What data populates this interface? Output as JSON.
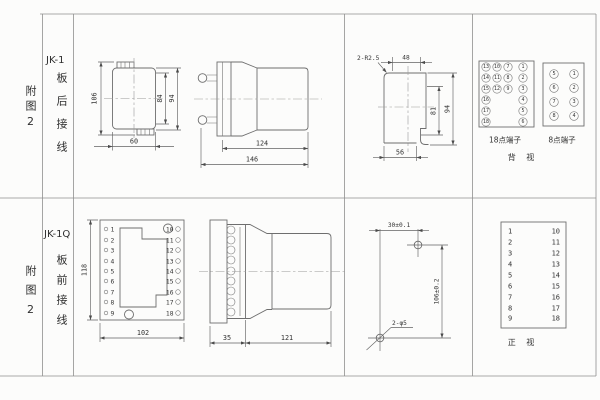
{
  "sidebar": {
    "row1": {
      "figure": "附图2",
      "model": "JK-1",
      "wiring": "板后接线"
    },
    "row2": {
      "figure": "附图2",
      "model": "JK-1Q",
      "wiring": "板前接线"
    }
  },
  "rear_view": {
    "dim_height": "106",
    "dim_inner": "84",
    "dim_outer": "94",
    "dim_width": "60"
  },
  "side_view_top": {
    "dim_body": "124",
    "dim_overall": "146"
  },
  "cutout": {
    "radius_note": "2-R2.5",
    "dim_top": "48",
    "dim_inner_h": "81",
    "dim_outer_h": "94",
    "dim_bottom": "56"
  },
  "terminals18": {
    "label": "18点端子",
    "col_outer_left": [
      "13",
      "14",
      "15",
      "16",
      "17",
      "18"
    ],
    "col_inner_left": [
      "10",
      "11",
      "12"
    ],
    "col_inner_right": [
      "7",
      "8",
      "9"
    ],
    "col_outer_right": [
      "1",
      "2",
      "3",
      "4",
      "5",
      "6"
    ]
  },
  "terminals8": {
    "label": "8点端子",
    "col_left": [
      "5",
      "6",
      "7",
      "8"
    ],
    "col_right": [
      "1",
      "2",
      "3",
      "4"
    ]
  },
  "rear_label": "背 视",
  "front_plate": {
    "dim_height": "118",
    "dim_width": "102",
    "left_terminals": [
      "1",
      "2",
      "3",
      "4",
      "5",
      "6",
      "7",
      "8",
      "9"
    ],
    "right_terminals": [
      "10",
      "11",
      "12",
      "13",
      "14",
      "15",
      "16",
      "17",
      "18"
    ]
  },
  "side_view_bottom": {
    "dim_plate": "35",
    "dim_body": "121"
  },
  "drill": {
    "dim_h": "30±0.1",
    "dim_v": "106±0.2",
    "holes": "2-φ5"
  },
  "front_table": {
    "left": [
      "1",
      "2",
      "3",
      "4",
      "5",
      "6",
      "7",
      "8",
      "9"
    ],
    "right": [
      "10",
      "11",
      "12",
      "13",
      "14",
      "15",
      "16",
      "17",
      "18"
    ],
    "label": "正 视"
  }
}
